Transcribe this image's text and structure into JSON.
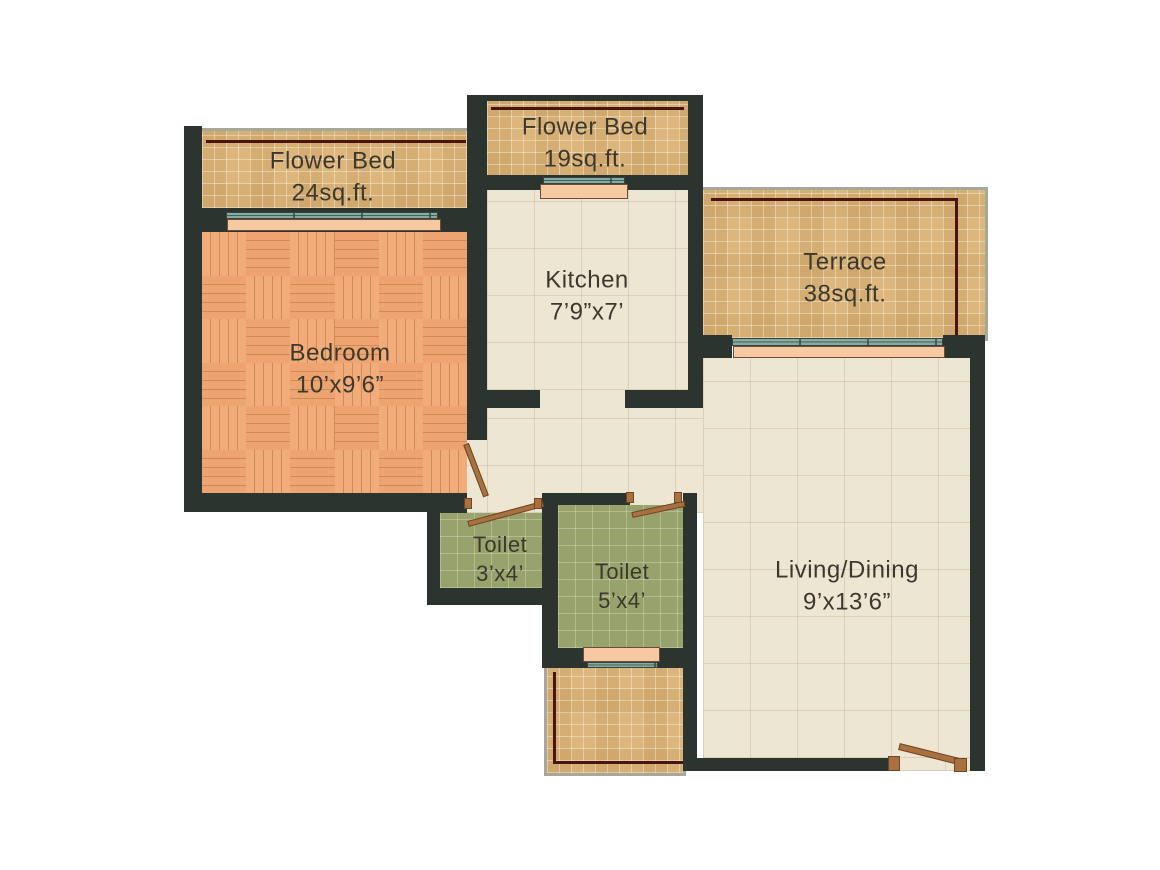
{
  "plan": {
    "colors": {
      "wall": "#2c342f",
      "tan": "#dcb67c",
      "cream": "#ece6d3",
      "green": "#98a26c",
      "parquet": "#eca774",
      "window": "#85aba4",
      "sill": "#f7c9a2",
      "door": "#a8713f",
      "maroon": "#4a150e",
      "gray": "#a7a79c",
      "text": "#3b392e"
    },
    "rooms": [
      {
        "id": "flower-bed-24",
        "name": "Flower Bed",
        "dims": "24sq.ft."
      },
      {
        "id": "flower-bed-19",
        "name": "Flower Bed",
        "dims": "19sq.ft."
      },
      {
        "id": "kitchen",
        "name": "Kitchen",
        "dims": "7’9”x7’"
      },
      {
        "id": "terrace",
        "name": "Terrace",
        "dims": "38sq.ft."
      },
      {
        "id": "bedroom",
        "name": "Bedroom",
        "dims": "10’x9’6”"
      },
      {
        "id": "toilet-small",
        "name": "Toilet",
        "dims": "3’x4’"
      },
      {
        "id": "toilet-large",
        "name": "Toilet",
        "dims": "5’x4’"
      },
      {
        "id": "living-dining",
        "name": "Living/Dining",
        "dims": "9’x13’6”"
      }
    ]
  }
}
